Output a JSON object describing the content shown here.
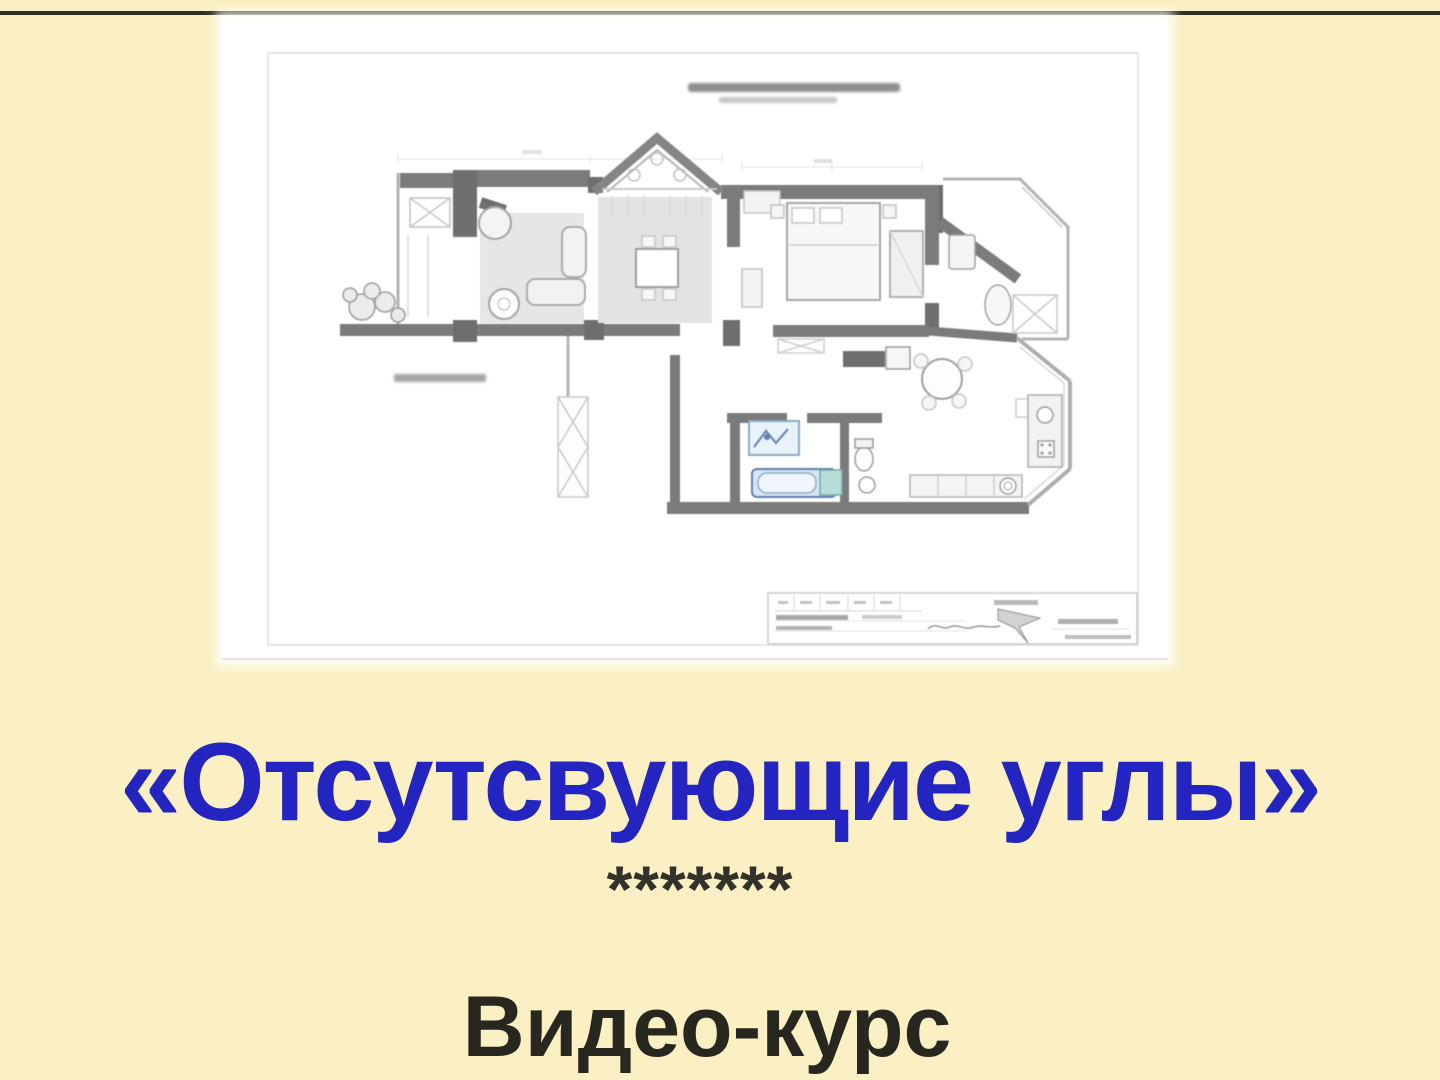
{
  "page": {
    "background": "#FAF0C4",
    "top_rule_color": "#2F2F24"
  },
  "poster": {
    "title": "«Отсутсвующие углы»",
    "title_color": "#2424C0",
    "separator_stars": "*******",
    "subtitle": "Видео-курс",
    "subtitle_color": "#28271F"
  },
  "floorplan": {
    "description": "blurred apartment furniture-layout drawing; captions and title block illegible",
    "paper_color": "#FFFFFF",
    "wall_color": "#7B7B7B",
    "pier_color": "#6E6E6E",
    "light_line_color": "#B5B5B5",
    "rug_fill": "#E5E5E5",
    "bath_blue": "#5F7FB0",
    "bath_teal": "#6FA9A5"
  }
}
